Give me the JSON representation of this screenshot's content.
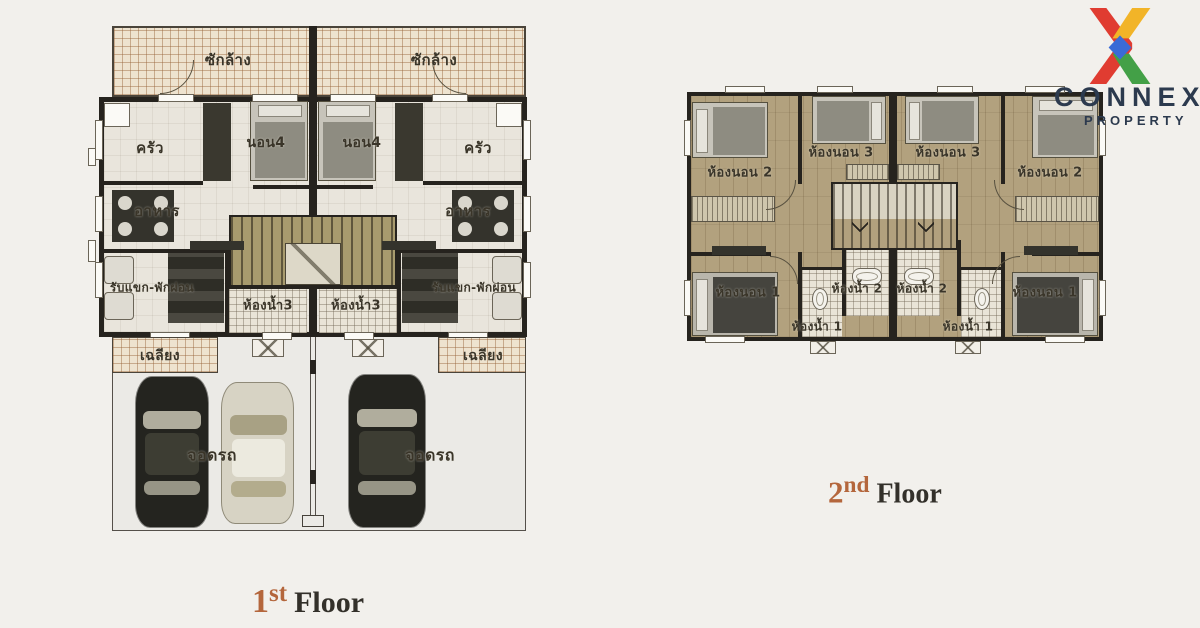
{
  "page": {
    "background": "#f2f0ec"
  },
  "logo": {
    "brand": "CONNEX",
    "tagline": "PROPERTY",
    "colors": {
      "navy": "#2c3a4e",
      "red": "#e03c31",
      "yellow": "#f2b428",
      "green": "#43a047",
      "blue": "#3a6bd6"
    }
  },
  "first_floor": {
    "caption": {
      "ordinal": "1",
      "suffix": "st",
      "word": "Floor"
    },
    "labels": {
      "laundry": "ซักล้าง",
      "kitchen": "ครัว",
      "bedroom4": "นอน4",
      "dining": "อาหาร",
      "living": "รับแขก-พักผ่อน",
      "bathroom3": "ห้องน้ำ3",
      "porch": "เฉลียง",
      "carport": "จอดรถ"
    }
  },
  "second_floor": {
    "caption": {
      "ordinal": "2",
      "suffix": "nd",
      "word": "Floor"
    },
    "labels": {
      "bedroom1": "ห้องนอน 1",
      "bedroom2": "ห้องนอน 2",
      "bedroom3": "ห้องนอน 3",
      "bathroom1": "ห้องน้ำ 1",
      "bathroom2": "ห้องน้ำ 2"
    }
  }
}
